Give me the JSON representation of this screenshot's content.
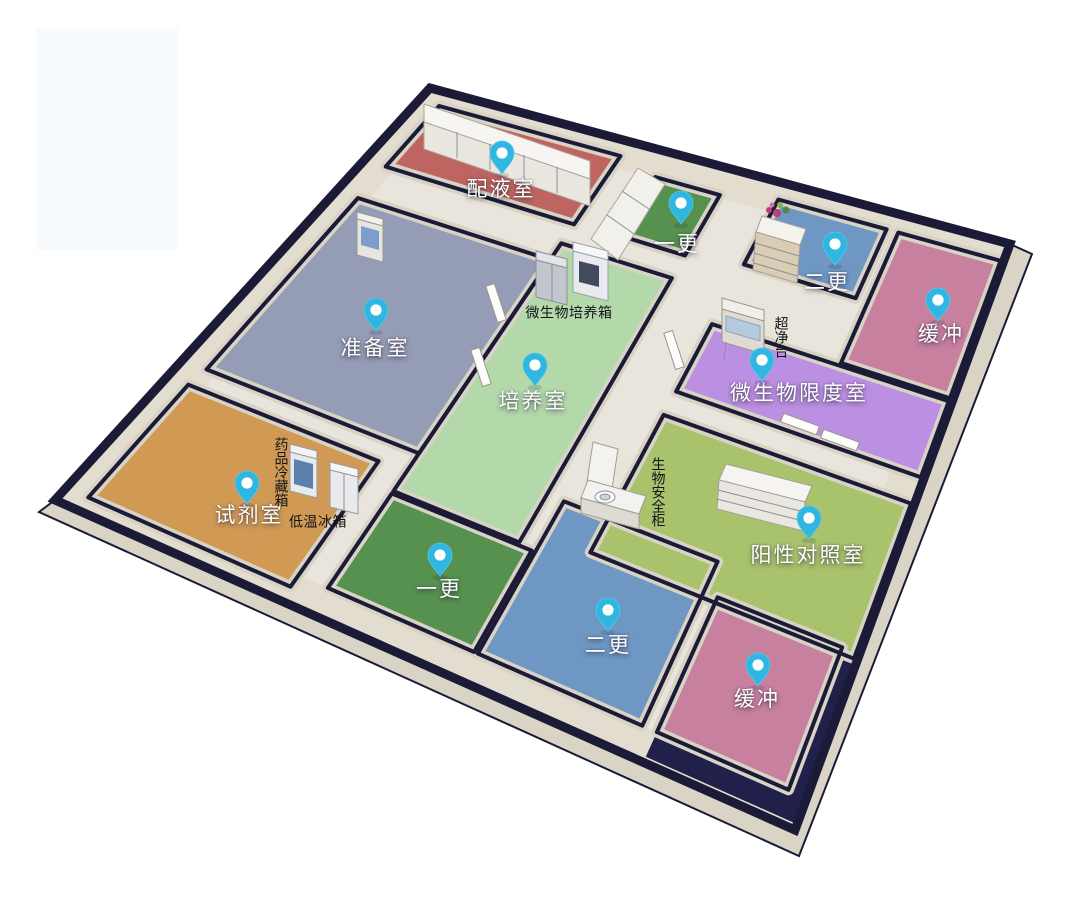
{
  "scene": {
    "type": "3d-lab-floorplan",
    "background": "#ffffff"
  },
  "palette": {
    "outer_wall": "#1b1b38",
    "wall_face": "#d8d3c5",
    "wall_band": "#e2ddcf",
    "corridor_floor": "#e9e5dc",
    "skirt": "#d9d4c6",
    "shadow_patch": "#20204a",
    "pin_body": "#2fb6e1",
    "pin_hole": "#ffffff"
  },
  "rooms": [
    {
      "id": "peiyeshi",
      "label": "配液室",
      "floor_color": "#bf6561",
      "pin": {
        "x": 502,
        "y": 174
      },
      "label_pos": {
        "x": 501,
        "y": 188
      }
    },
    {
      "id": "yigeng_top",
      "label": "一更",
      "floor_color": "#579150",
      "pin": {
        "x": 681,
        "y": 224
      },
      "label_pos": {
        "x": 677,
        "y": 243
      }
    },
    {
      "id": "ergeng_top",
      "label": "二更",
      "floor_color": "#6f97c4",
      "pin": {
        "x": 835,
        "y": 265
      },
      "label_pos": {
        "x": 827,
        "y": 281
      }
    },
    {
      "id": "huanchong_top",
      "label": "缓冲",
      "floor_color": "#c8809f",
      "pin": {
        "x": 938,
        "y": 321
      },
      "label_pos": {
        "x": 941,
        "y": 333
      }
    },
    {
      "id": "zhunbeishi",
      "label": "准备室",
      "floor_color": "#959cb5",
      "pin": {
        "x": 376,
        "y": 331
      },
      "label_pos": {
        "x": 375,
        "y": 347
      }
    },
    {
      "id": "peiyangshi",
      "label": "培养室",
      "floor_color": "#b3d8aa",
      "pin": {
        "x": 535,
        "y": 386
      },
      "label_pos": {
        "x": 533,
        "y": 400
      }
    },
    {
      "id": "xiandu",
      "label": "微生物限度室",
      "floor_color": "#bb90e2",
      "pin": {
        "x": 762,
        "y": 381
      },
      "label_pos": {
        "x": 799,
        "y": 392
      }
    },
    {
      "id": "shiji",
      "label": "试剂室",
      "floor_color": "#d09a55",
      "pin": {
        "x": 247,
        "y": 504
      },
      "label_pos": {
        "x": 249,
        "y": 514
      }
    },
    {
      "id": "yigeng_bottom",
      "label": "一更",
      "floor_color": "#579150",
      "pin": {
        "x": 440,
        "y": 576
      },
      "label_pos": {
        "x": 439,
        "y": 588
      }
    },
    {
      "id": "ergeng_bottom",
      "label": "二更",
      "floor_color": "#6f97c4",
      "pin": {
        "x": 608,
        "y": 631
      },
      "label_pos": {
        "x": 608,
        "y": 644
      }
    },
    {
      "id": "huanchong_bottom",
      "label": "缓冲",
      "floor_color": "#c8809f",
      "pin": {
        "x": 758,
        "y": 686
      },
      "label_pos": {
        "x": 757,
        "y": 698
      }
    },
    {
      "id": "yangxing",
      "label": "阳性对照室",
      "floor_color": "#a9c26c",
      "pin": {
        "x": 809,
        "y": 539
      },
      "label_pos": {
        "x": 808,
        "y": 554
      }
    }
  ],
  "equipment_labels": [
    {
      "id": "weishengwu_peiyangxiang",
      "text": "微生物培养箱",
      "orientation": "horizontal",
      "x": 569,
      "y": 314
    },
    {
      "id": "chaojingtai",
      "text": "超净台",
      "orientation": "vertical",
      "x": 780,
      "y": 337
    },
    {
      "id": "yaopin_lengcangxiang",
      "text": "药品冷藏箱",
      "orientation": "vertical",
      "x": 280,
      "y": 472
    },
    {
      "id": "diwen_bingxiang",
      "text": "低温冰箱",
      "orientation": "horizontal",
      "x": 318,
      "y": 523
    },
    {
      "id": "shengwu_anquangui",
      "text": "生物安全柜",
      "orientation": "vertical",
      "x": 657,
      "y": 492
    }
  ]
}
